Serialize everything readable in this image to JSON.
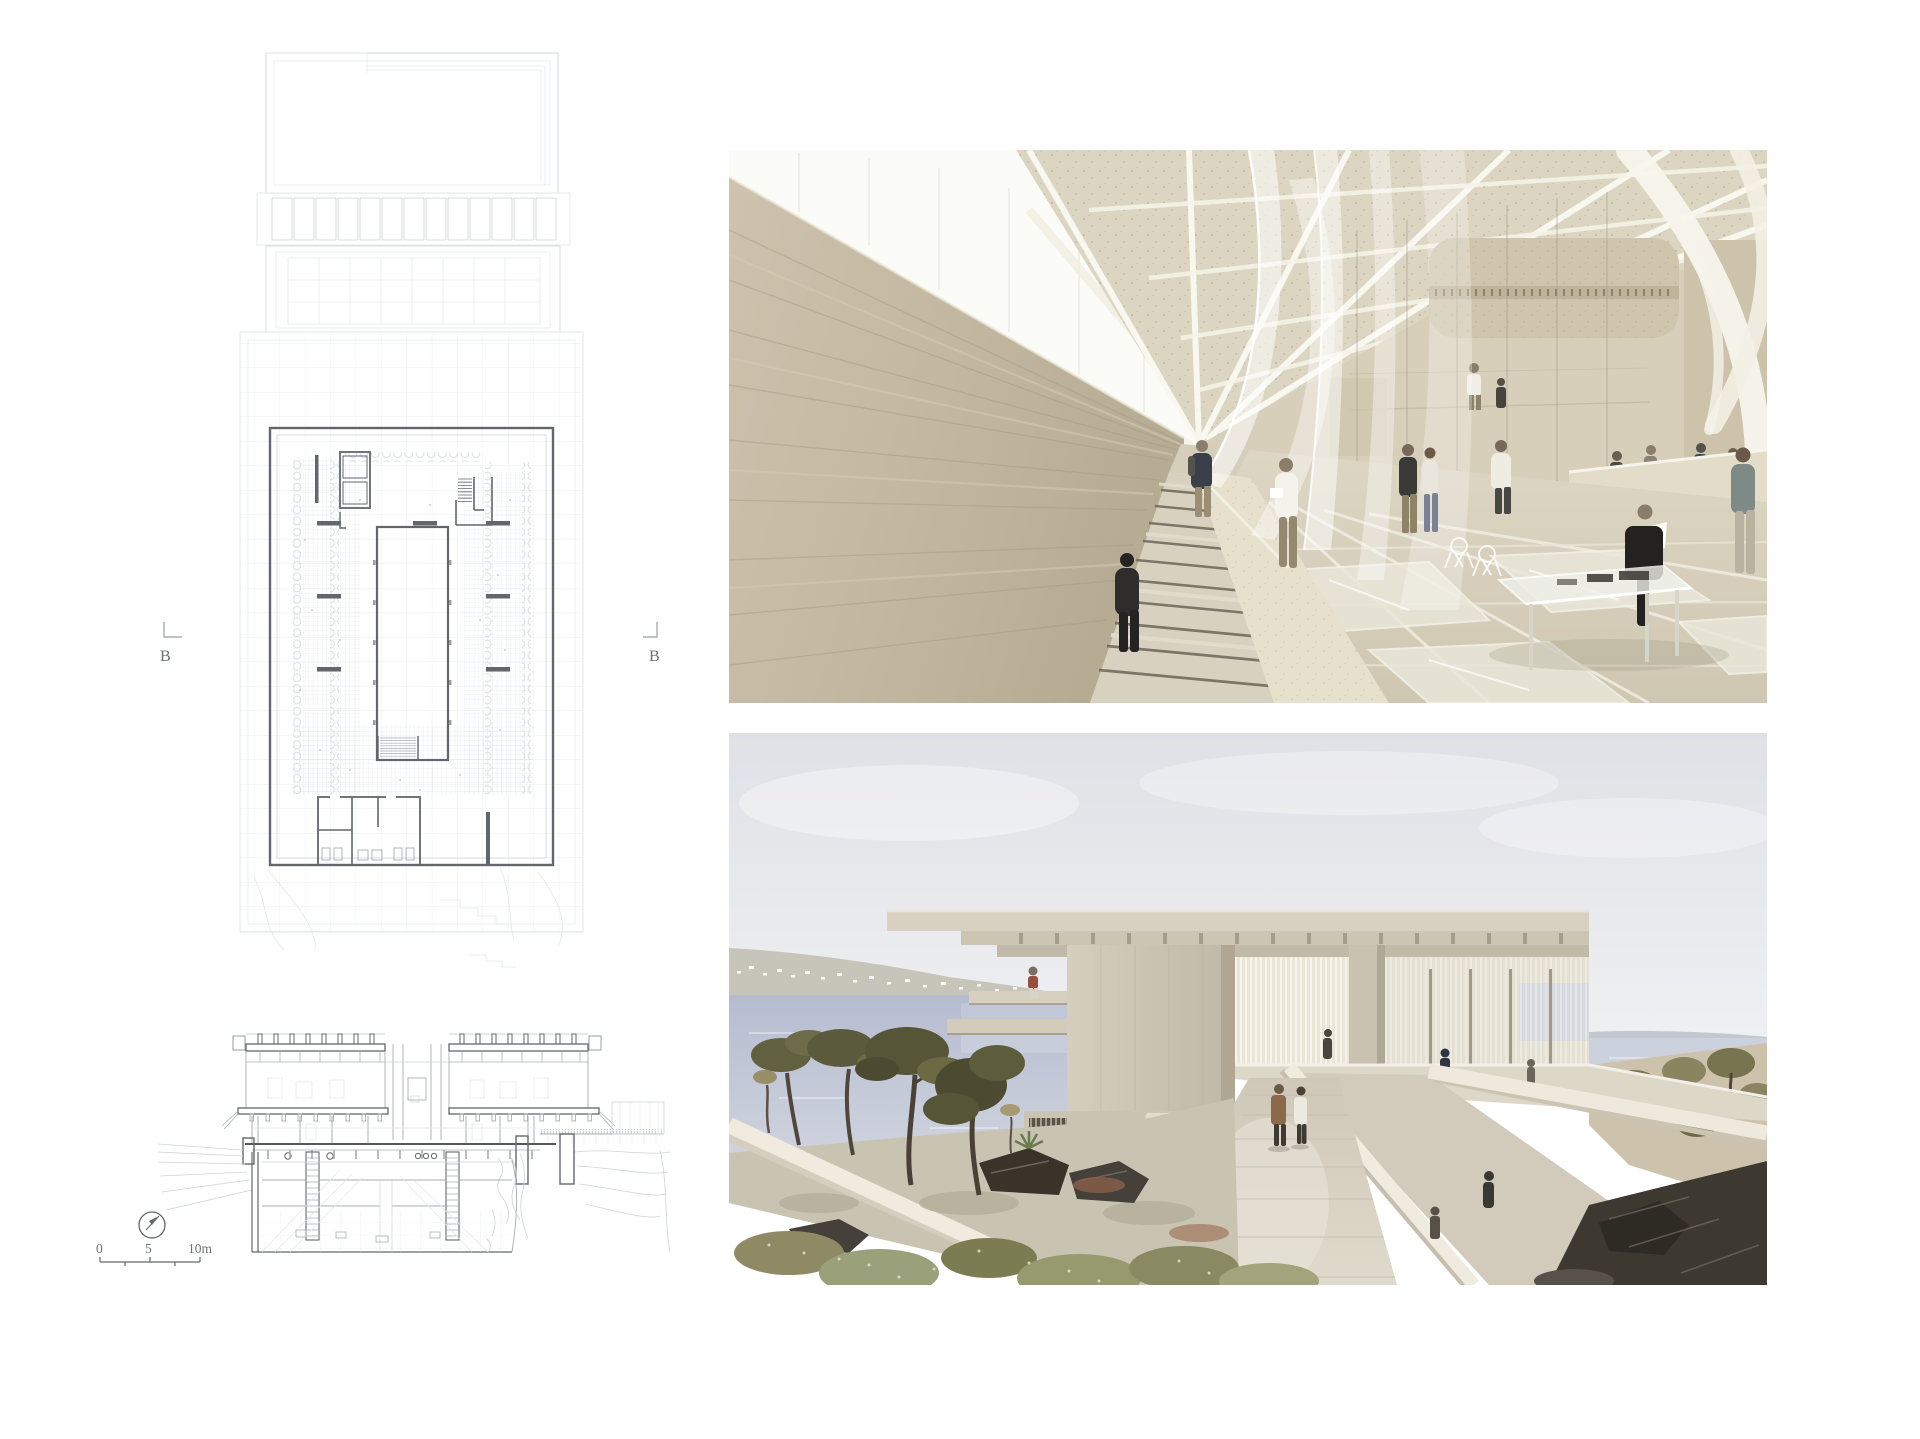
{
  "board": {
    "section_marker_label": "B",
    "scale_bar": {
      "label_0": "0",
      "label_5": "5",
      "label_10": "10m"
    }
  },
  "colors": {
    "line_bold": "#63676b",
    "line_medium": "#a8adb3",
    "line_light": "#ced3d8",
    "line_faint": "#e3e6ea",
    "travertine": "#c4b9a3",
    "concrete": "#d2cbba",
    "sea": "#bcc2d4",
    "sky": "#e1e2e7",
    "tree_olive": "#5f5d3e",
    "rock_dark": "#3e3930",
    "figure_dark": "#2e2d2b",
    "coat_brown": "#8a6a4a",
    "brass": "#c8b46f"
  }
}
